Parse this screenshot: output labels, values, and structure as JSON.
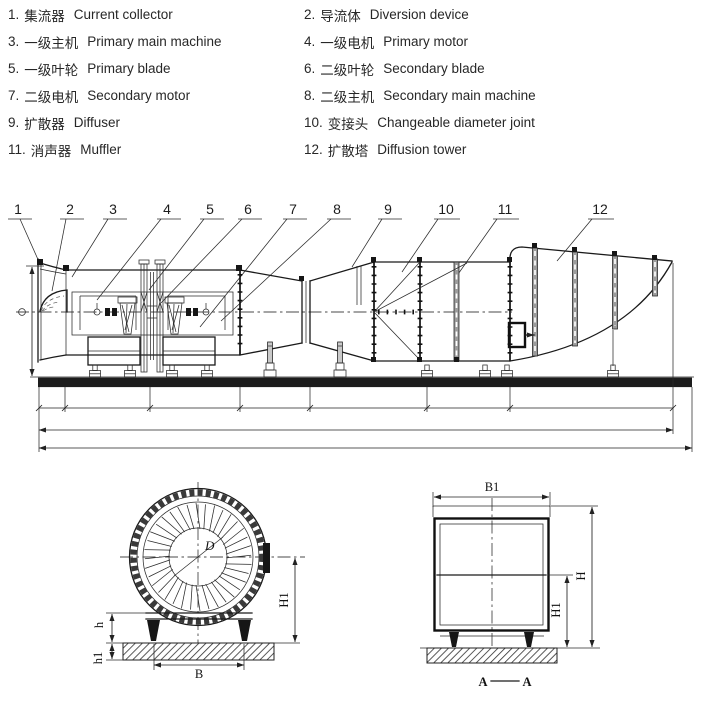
{
  "legend": {
    "items": [
      {
        "num": "1.",
        "zh": "集流器",
        "en": "Current collector"
      },
      {
        "num": "2.",
        "zh": "导流体",
        "en": "Diversion device"
      },
      {
        "num": "3.",
        "zh": "一级主机",
        "en": "Primary main machine"
      },
      {
        "num": "4.",
        "zh": "一级电机",
        "en": "Primary motor"
      },
      {
        "num": "5.",
        "zh": "一级叶轮",
        "en": "Primary blade"
      },
      {
        "num": "6.",
        "zh": "二级叶轮",
        "en": "Secondary blade"
      },
      {
        "num": "7.",
        "zh": "二级电机",
        "en": "Secondary motor"
      },
      {
        "num": "8.",
        "zh": "二级主机",
        "en": "Secondary main machine"
      },
      {
        "num": "9.",
        "zh": "扩散器",
        "en": "Diffuser"
      },
      {
        "num": "10.",
        "zh": "变接头",
        "en": "Changeable diameter joint"
      },
      {
        "num": "11.",
        "zh": "消声器",
        "en": "Muffler"
      },
      {
        "num": "12.",
        "zh": "扩散塔",
        "en": "Diffusion tower"
      }
    ]
  },
  "side_view": {
    "callouts": [
      "1",
      "2",
      "3",
      "4",
      "5",
      "6",
      "7",
      "8",
      "9",
      "10",
      "11",
      "12"
    ]
  },
  "front_view": {
    "labels": {
      "diameter": "D",
      "height": "H1",
      "foot_height": "h",
      "foundation_depth": "h1",
      "base_width": "B"
    }
  },
  "section_view": {
    "labels": {
      "width": "B1",
      "height": "H",
      "inner_height": "H1",
      "section_left": "A",
      "section_right": "A"
    }
  },
  "colors": {
    "line": "#1a1a1a",
    "foundation": "#1c1c1c",
    "background": "#ffffff"
  }
}
